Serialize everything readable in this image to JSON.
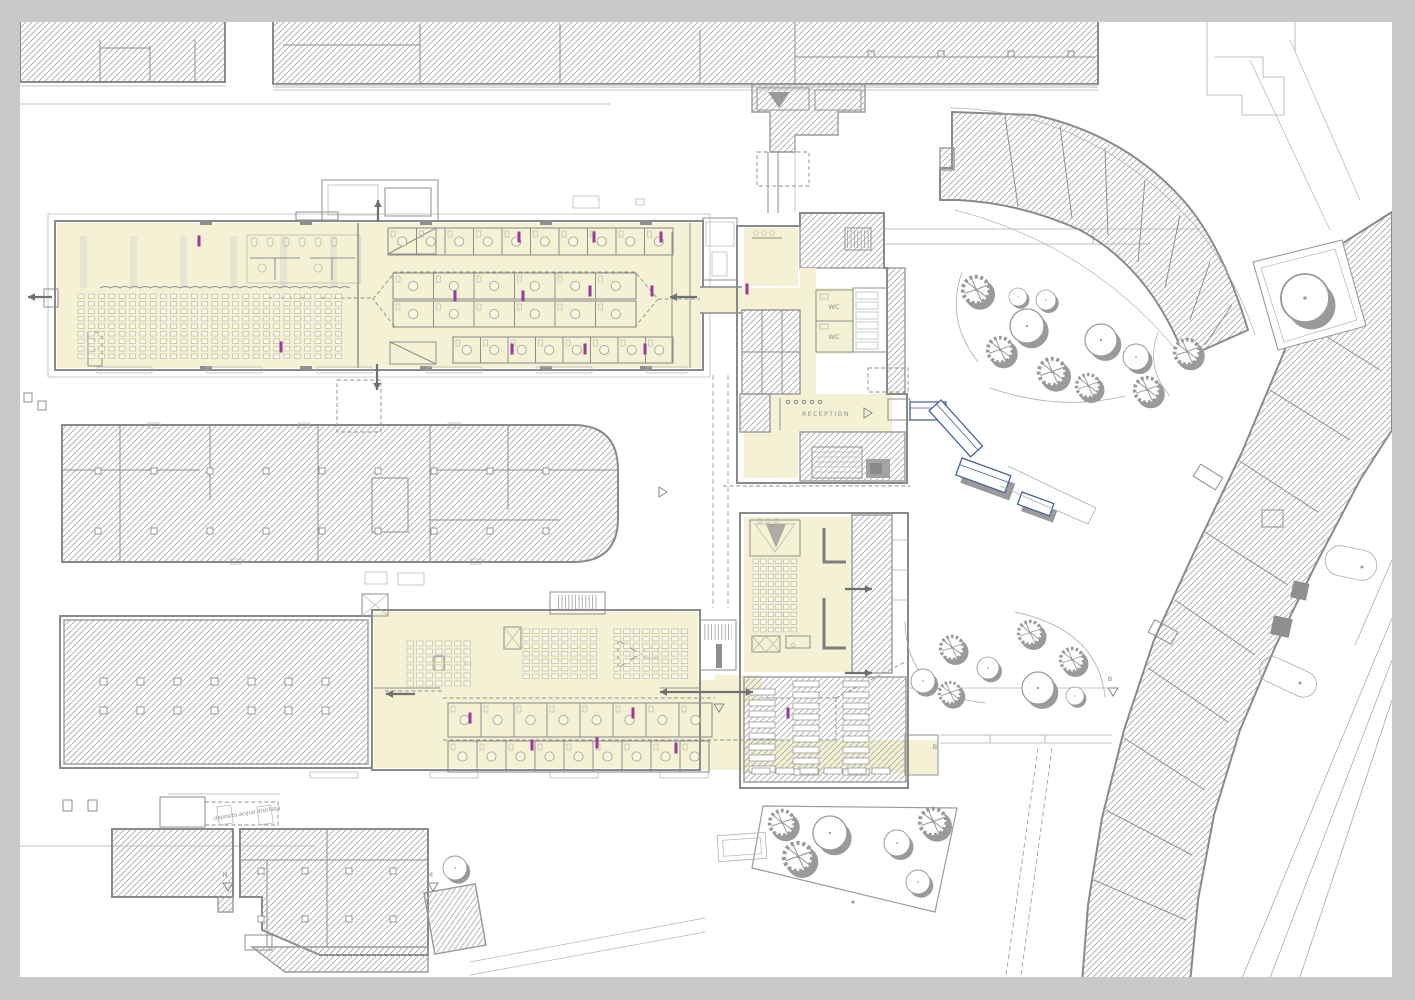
{
  "plan": {
    "labels": {
      "wc1": "WC",
      "wc2": "WC",
      "reception": "RECEPTION",
      "water_shed_note": "deposito acqua distillata"
    },
    "markers": [
      {
        "t": "N",
        "x": 225,
        "y": 877
      },
      {
        "t": "M",
        "x": 430,
        "y": 877
      },
      {
        "t": "B",
        "x": 935,
        "y": 749
      },
      {
        "t": "B",
        "x": 1110,
        "y": 681
      }
    ],
    "triangles": [
      {
        "x": 228,
        "y": 887,
        "dir": "d"
      },
      {
        "x": 433,
        "y": 887,
        "dir": "d"
      },
      {
        "x": 663,
        "y": 492,
        "dir": "r"
      },
      {
        "x": 719,
        "y": 708,
        "dir": "d"
      },
      {
        "x": 1113,
        "y": 692,
        "dir": "d"
      },
      {
        "x": 868,
        "y": 413,
        "dir": "r"
      }
    ],
    "palette": {
      "floor_yellow": "#f5f1d4",
      "wall_gray": "#8a8a8a",
      "hatch_gray": "#a6a6a6",
      "door_magenta": "#9a3a96",
      "ramp_blue": "#45629e",
      "tree_gray": "#9a9a9a",
      "frame_gray": "#c9c9c9",
      "paper_white": "#ffffff"
    },
    "trees": {
      "spiky": [
        [
          976,
          290,
          15
        ],
        [
          1000,
          350,
          14
        ],
        [
          1052,
          372,
          15
        ],
        [
          1088,
          386,
          13
        ],
        [
          1147,
          390,
          14
        ],
        [
          1187,
          352,
          14
        ],
        [
          952,
          648,
          13
        ],
        [
          950,
          693,
          12
        ],
        [
          1030,
          633,
          13
        ],
        [
          1072,
          660,
          13
        ],
        [
          782,
          823,
          14
        ],
        [
          798,
          857,
          16
        ],
        [
          933,
          822,
          15
        ]
      ],
      "round": [
        [
          1018,
          297,
          9
        ],
        [
          1046,
          300,
          10
        ],
        [
          1027,
          326,
          17
        ],
        [
          1101,
          340,
          16
        ],
        [
          1136,
          357,
          13
        ],
        [
          923,
          681,
          12
        ],
        [
          988,
          668,
          11
        ],
        [
          1038,
          688,
          16
        ],
        [
          1075,
          696,
          9
        ],
        [
          830,
          833,
          17
        ],
        [
          897,
          843,
          13
        ],
        [
          918,
          882,
          12
        ],
        [
          455,
          868,
          12
        ],
        [
          1305,
          298,
          24
        ]
      ]
    },
    "seat_grids": [
      {
        "x": 78,
        "y": 294,
        "cols": 26,
        "rows": 9,
        "dx": 10.3,
        "dy": 7.5,
        "w": 6,
        "h": 4.5
      },
      {
        "x": 407,
        "y": 641,
        "cols": 7,
        "rows": 6,
        "dx": 9.5,
        "dy": 8,
        "w": 6.5,
        "h": 5
      },
      {
        "x": 523,
        "y": 629,
        "cols": 8,
        "rows": 7,
        "dx": 9.6,
        "dy": 7.5,
        "w": 6.5,
        "h": 4.5
      },
      {
        "x": 614,
        "y": 629,
        "cols": 8,
        "rows": 7,
        "dx": 9.6,
        "dy": 7.5,
        "w": 6.5,
        "h": 4.5
      },
      {
        "x": 753,
        "y": 559,
        "cols": 6,
        "rows": 10,
        "dx": 7.6,
        "dy": 7.6,
        "w": 5.5,
        "h": 4.5
      }
    ],
    "cubicle_rows": [
      {
        "x": 388,
        "y": 228,
        "n": 10,
        "w": 28.5,
        "h": 27
      },
      {
        "x": 393,
        "y": 273,
        "n": 6,
        "w": 40.5,
        "h": 26
      },
      {
        "x": 393,
        "y": 301,
        "n": 6,
        "w": 40.5,
        "h": 26
      },
      {
        "x": 453,
        "y": 337,
        "n": 8,
        "w": 27.5,
        "h": 26
      },
      {
        "x": 448,
        "y": 703,
        "n": 8,
        "w": 33,
        "h": 34
      },
      {
        "x": 448,
        "y": 741,
        "n": 9,
        "w": 29,
        "h": 31
      }
    ],
    "bench_rows": [
      {
        "x": 749,
        "y": 689,
        "n": 8,
        "w": 26,
        "h": 6,
        "gap": 11,
        "dir": "v"
      },
      {
        "x": 793,
        "y": 681,
        "n": 9,
        "w": 26,
        "h": 6,
        "gap": 11,
        "dir": "v"
      },
      {
        "x": 843,
        "y": 681,
        "n": 9,
        "w": 26,
        "h": 6,
        "gap": 11,
        "dir": "v"
      },
      {
        "x": 752,
        "y": 768,
        "n": 6,
        "w": 18,
        "h": 6,
        "gap": 24,
        "dir": "h"
      }
    ],
    "column_grids": [
      {
        "x": 100,
        "y": 678,
        "nx": 7,
        "ny": 2,
        "dx": 37,
        "dy": 29,
        "s": 7
      },
      {
        "x": 95,
        "y": 468,
        "nx": 9,
        "ny": 2,
        "dx": 56,
        "dy": 60,
        "s": 6
      },
      {
        "x": 258,
        "y": 868,
        "nx": 4,
        "ny": 2,
        "dx": 44,
        "dy": 48,
        "s": 6
      }
    ],
    "door_markers": [
      [
        199,
        241
      ],
      [
        519,
        237
      ],
      [
        594,
        237
      ],
      [
        661,
        237
      ],
      [
        455,
        296
      ],
      [
        523,
        296
      ],
      [
        590,
        291
      ],
      [
        652,
        291
      ],
      [
        281,
        347
      ],
      [
        512,
        349
      ],
      [
        585,
        349
      ],
      [
        645,
        349
      ],
      [
        747,
        289
      ],
      [
        470,
        718
      ],
      [
        633,
        713
      ],
      [
        788,
        713
      ],
      [
        532,
        745
      ],
      [
        597,
        743
      ],
      [
        676,
        748
      ]
    ],
    "arrows": [
      {
        "x1": 52,
        "y1": 297,
        "x2": 28,
        "y2": 297
      },
      {
        "x1": 697,
        "y1": 297,
        "x2": 670,
        "y2": 297
      },
      {
        "x1": 378,
        "y1": 222,
        "x2": 378,
        "y2": 200
      },
      {
        "x1": 377,
        "y1": 364,
        "x2": 377,
        "y2": 390
      },
      {
        "x1": 415,
        "y1": 694,
        "x2": 386,
        "y2": 694
      },
      {
        "x1": 660,
        "y1": 692,
        "x2": 753,
        "y2": 692,
        "double": true
      },
      {
        "x1": 845,
        "y1": 589,
        "x2": 872,
        "y2": 589
      },
      {
        "x1": 845,
        "y1": 673,
        "x2": 872,
        "y2": 673
      }
    ],
    "wavy_line": {
      "x1": 100,
      "x2": 348,
      "y": 288,
      "step": 10,
      "amp": 3
    }
  }
}
